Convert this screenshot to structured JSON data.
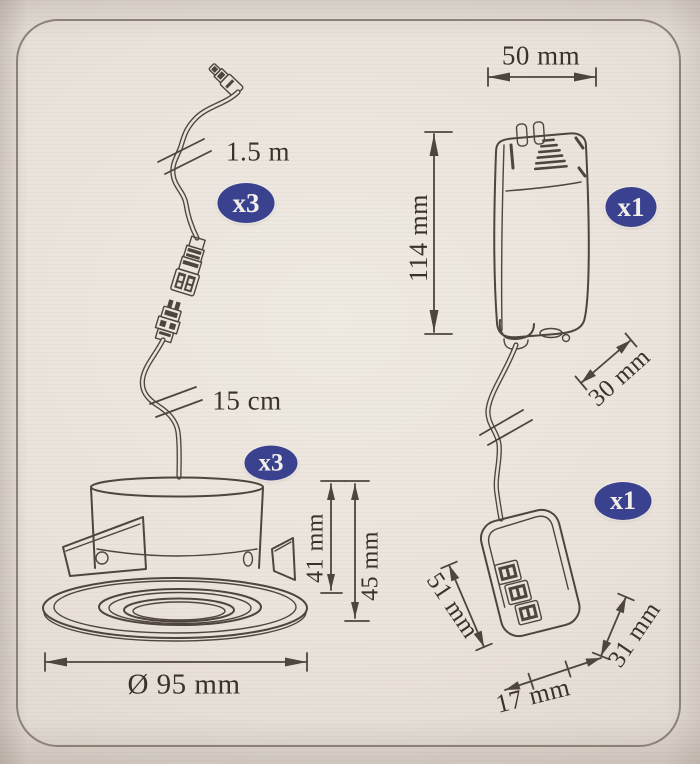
{
  "badges": {
    "cable_qty": "x3",
    "spot_qty": "x3",
    "driver_qty": "x1",
    "connector_qty": "x1"
  },
  "dimensions": {
    "cable_length": "1.5 m",
    "spot_cable_length": "15 cm",
    "driver_width": "50 mm",
    "driver_height": "114 mm",
    "driver_cable_length": "30 mm",
    "spot_recess_height": "41 mm",
    "spot_total_height": "45 mm",
    "spot_diameter": "Ø 95 mm",
    "connector_length": "51 mm",
    "connector_height": "31 mm",
    "connector_width": "17 mm"
  },
  "figures": {
    "cable": "supply-cable-with-quick-connectors",
    "spotlight": "recessed-spotlight",
    "driver": "led-driver-box",
    "connector": "terminal-connector-block"
  },
  "colors": {
    "badge_blue": "#3a418f",
    "line_art": "#4e463d",
    "dimension_text": "#3a322a",
    "card_background": "#e9e2da",
    "outer_background": "#d7cfc5",
    "frame_border": "#8b8177"
  }
}
